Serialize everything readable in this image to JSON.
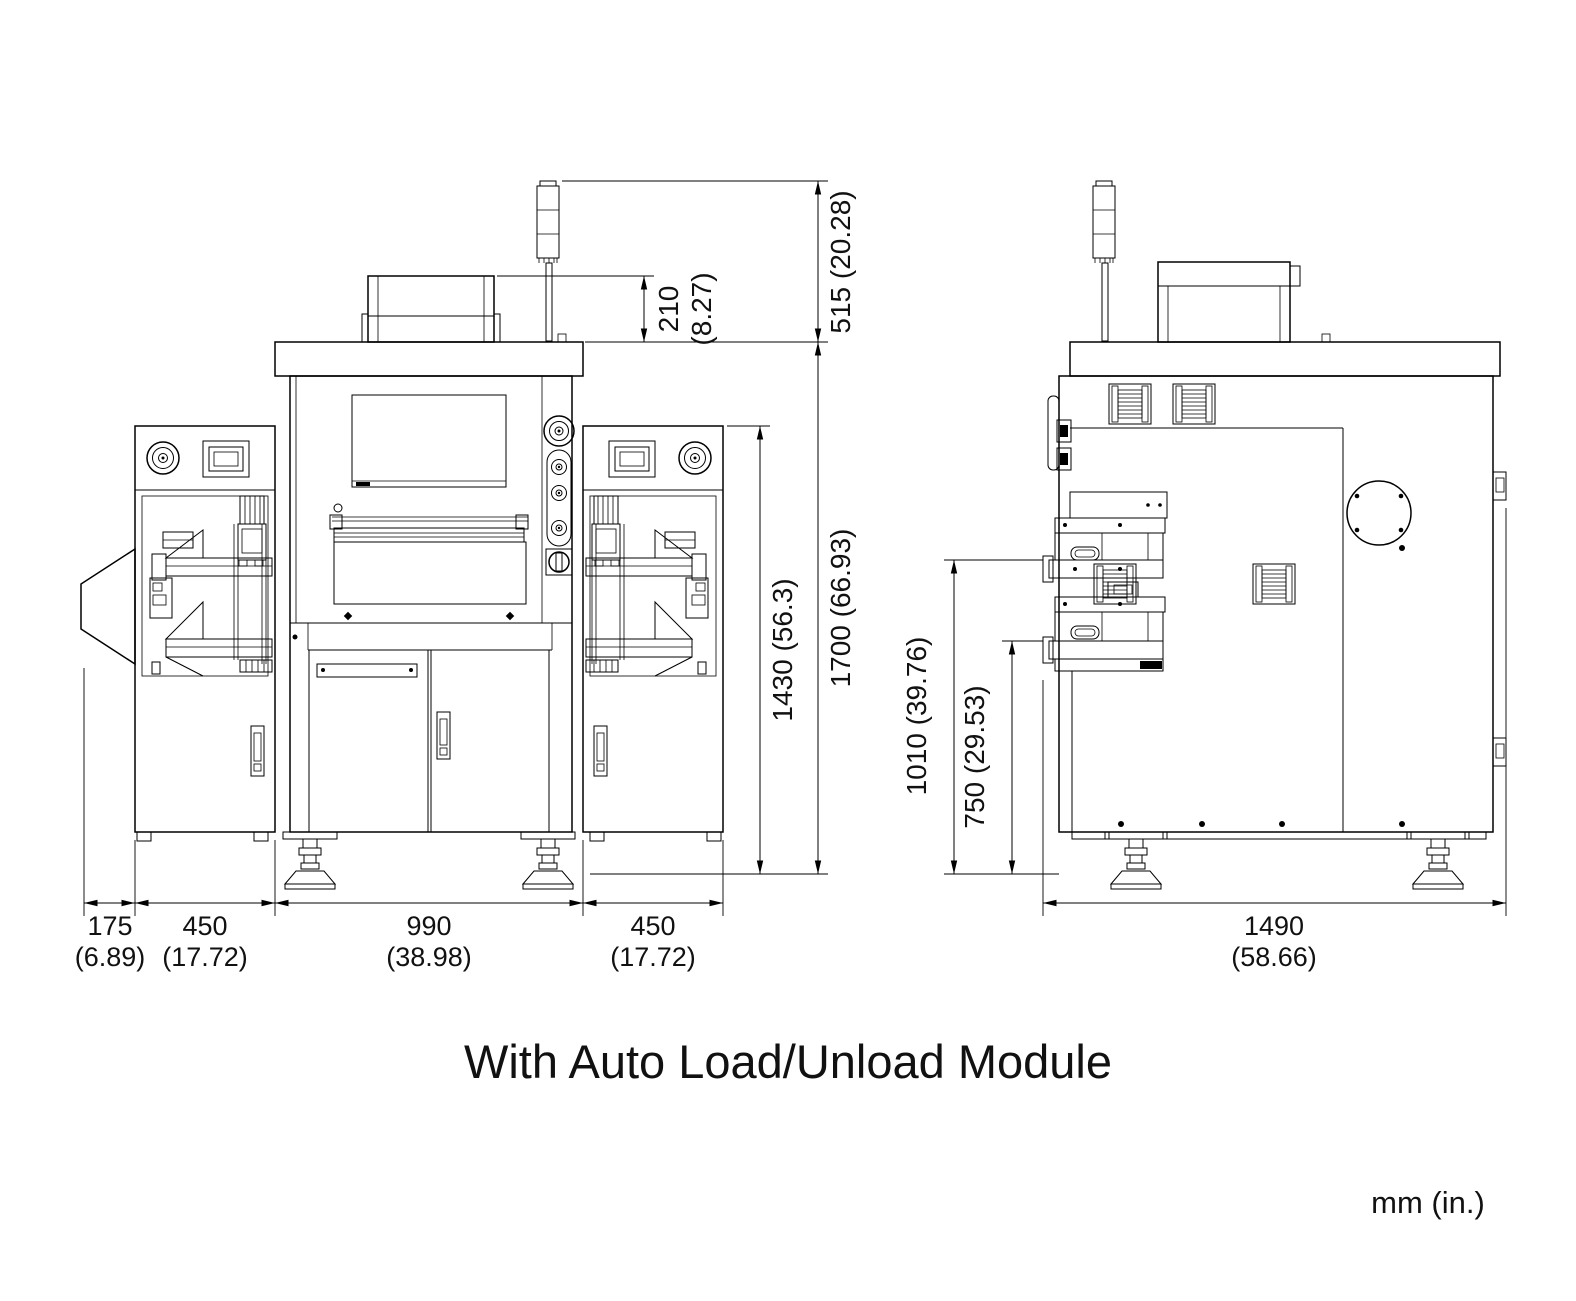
{
  "page": {
    "caption": "With Auto Load/Unload Module",
    "units_note": "mm (in.)"
  },
  "front_view": {
    "dims": {
      "tower_height": "515 (20.28)",
      "monitor_box_height_mm": "210",
      "monitor_box_height_in": "(8.27)",
      "module_height": "1430 (56.3)",
      "overall_height": "1700 (66.93)",
      "outrigger_width_mm": "175",
      "outrigger_width_in": "(6.89)",
      "left_module_width_mm": "450",
      "left_module_width_in": "(17.72)",
      "center_width_mm": "990",
      "center_width_in": "(38.98)",
      "right_module_width_mm": "450",
      "right_module_width_in": "(17.72)"
    }
  },
  "side_view": {
    "dims": {
      "upper_conveyor_height": "1010 (39.76)",
      "lower_conveyor_height": "750 (29.53)",
      "depth_mm": "1490",
      "depth_in": "(58.66)"
    }
  }
}
